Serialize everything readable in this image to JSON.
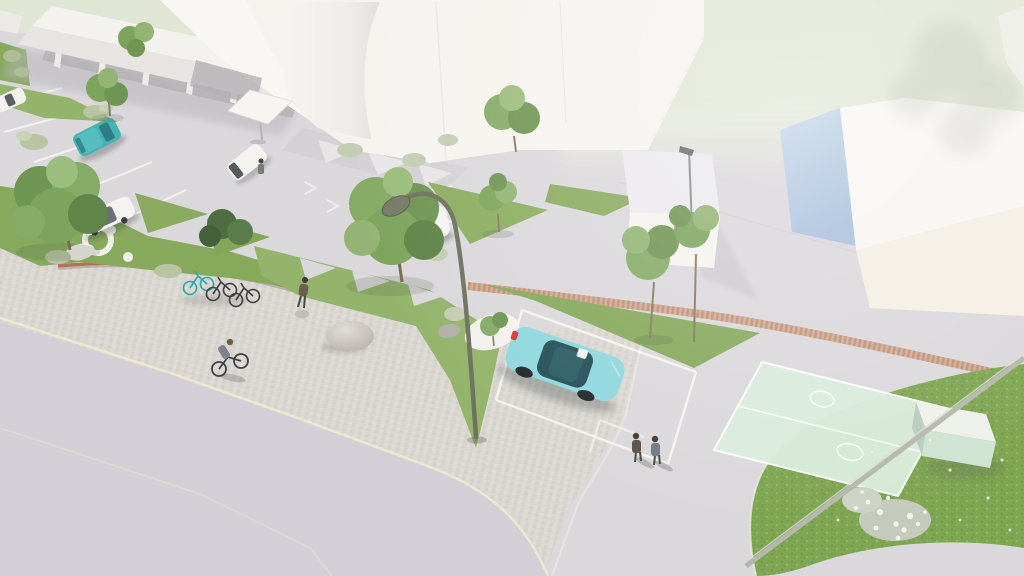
{
  "scene": {
    "kind": "aerial architectural 3d rendering",
    "no_visible_text": true,
    "sky": {
      "top": "#dfe6d4",
      "mid": "#e6eadd",
      "bottom": "#eceaec"
    },
    "ground": {
      "base": "#dbd8dc",
      "road": "#d2cfd6",
      "plaza_cobble_base": "#dad6d1",
      "curb_line": "#efe9d0",
      "red_brick_path": "#c08a6b",
      "wall_brick_edge": "#b5705a",
      "parking_line": "#f6f4f0"
    },
    "vegetation": {
      "grass": "#86a95c",
      "grass_light": "#94b46b",
      "lawn": "#7ea551",
      "tree_dark": "#5f8549",
      "tree_mid": "#7da45d",
      "tree_light": "#a3c27e",
      "shrub": "#b8c4a2",
      "flower_white": "#f3f2ec"
    },
    "buildings": {
      "canopy": "#f4f2ef",
      "facade_bright": "#f9f7f4",
      "facade_white": "#f6f3ef",
      "recess_shadow": "#b3b0b4",
      "roof_top": "#eceaf0",
      "gable_blue": "#bfd2e8",
      "front_cream": "#f5efe4"
    },
    "objects": {
      "lamp_olive": "#6e7260",
      "lamp_head": "#767a66",
      "pole_gray": "#b4b8ac",
      "court_mint": "#d9ecdc",
      "court_line": "#ffffff",
      "shed_mint": "#cfe3d2",
      "shed_roof": "#eef0ea",
      "stone_gray": "#cfccc6",
      "white_path": "#f3f1ed",
      "bike_dark": "#3c4043",
      "bike_teal": "#2aa7ad",
      "umbrella_white": "#f7f5f1"
    },
    "vehicles": {
      "teal_van": "#45b3b5",
      "mint_sedan": "#8fd8de",
      "mint_sedan_glass": "#265059",
      "white_car": "#f4f3f0",
      "glass_dark": "#33383e",
      "tail_light_red": "#d73a34"
    },
    "people_color": "#6b6661",
    "inventory": {
      "buildings": 6,
      "vehicles": 6,
      "bicycles": 4,
      "people": 5,
      "trees": 10,
      "street_lamps": 2,
      "sports_courts": 1,
      "marked_parking_bays": true
    }
  }
}
